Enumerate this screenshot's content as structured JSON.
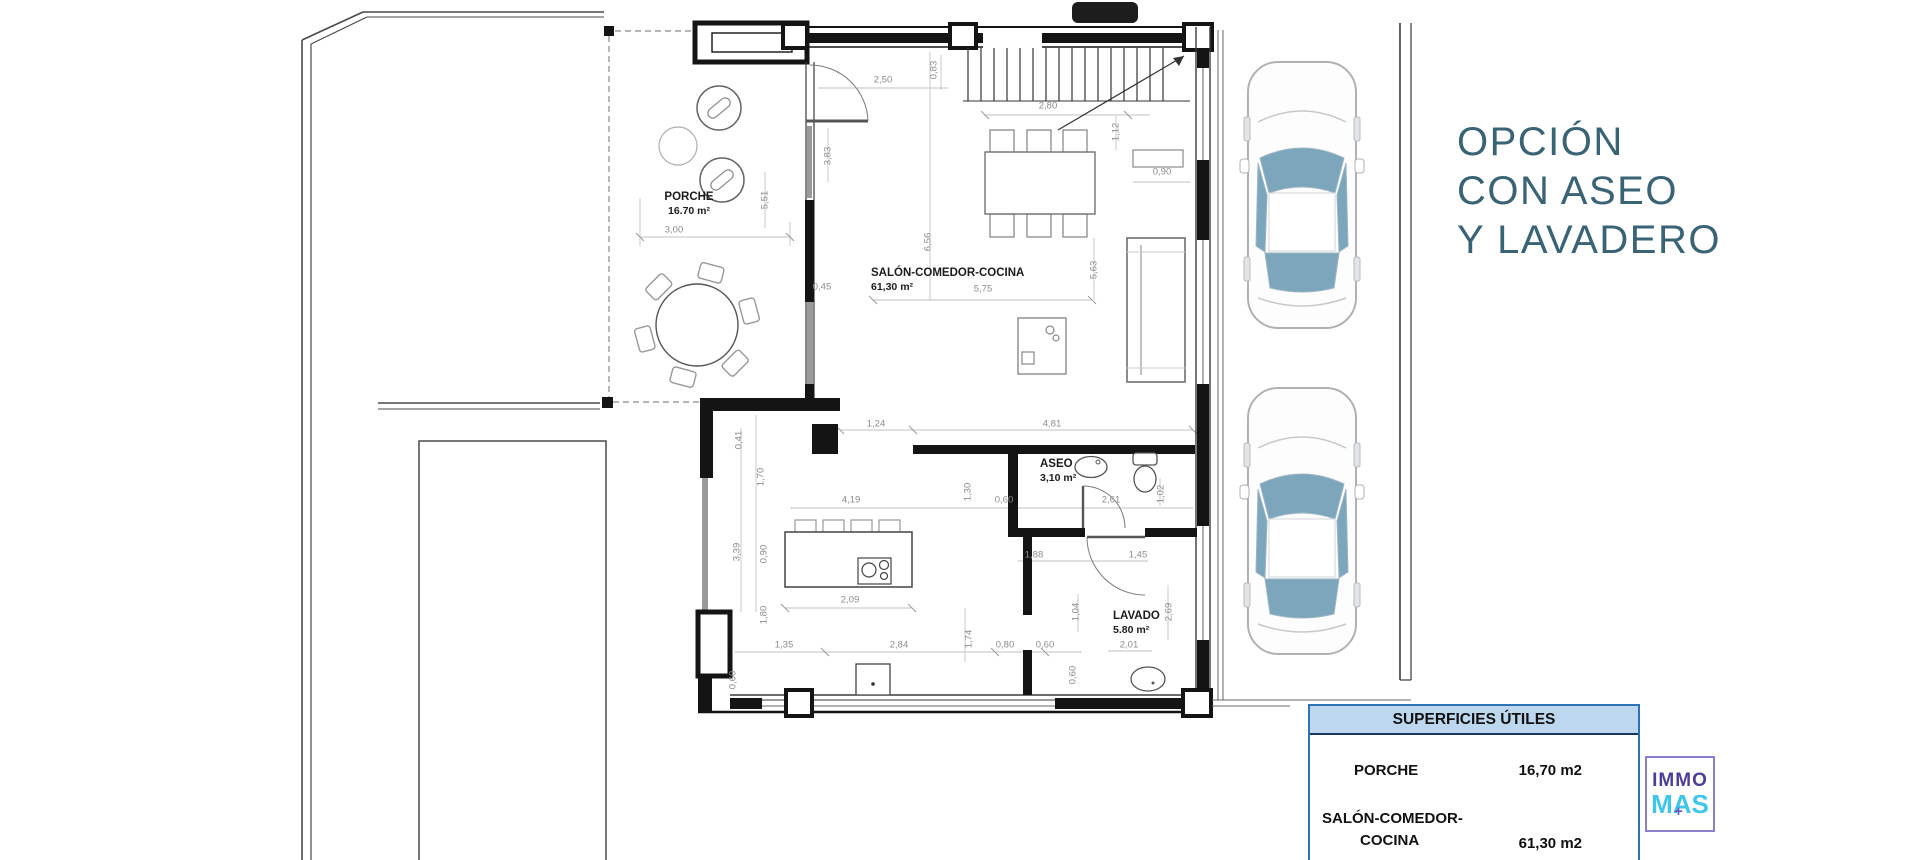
{
  "sidebar": {
    "title_lines": [
      "OPCIÓN",
      "CON ASEO",
      "Y LAVADERO"
    ]
  },
  "plan": {
    "room_labels": [
      {
        "name": "PORCHE",
        "area": "16.70 m²",
        "x": 689,
        "y": 190,
        "centered": true
      },
      {
        "name": "SALÓN-COMEDOR-COCINA",
        "area": "61,30 m²",
        "x": 871,
        "y": 266
      },
      {
        "name": "ASEO",
        "area": "3,10 m²",
        "x": 1040,
        "y": 457
      },
      {
        "name": "LAVADO",
        "area": "5.80 m²",
        "x": 1113,
        "y": 609
      }
    ],
    "dimension_labels": [
      {
        "t": "2,50",
        "x": 883,
        "y": 80
      },
      {
        "t": "0,83",
        "x": 934,
        "y": 70,
        "v": true
      },
      {
        "t": "2,80",
        "x": 1048,
        "y": 106
      },
      {
        "t": "1,12",
        "x": 1116,
        "y": 132,
        "v": true
      },
      {
        "t": "0,90",
        "x": 1162,
        "y": 172
      },
      {
        "t": "3,83",
        "x": 828,
        "y": 156,
        "v": true
      },
      {
        "t": "5,51",
        "x": 765,
        "y": 200,
        "v": true
      },
      {
        "t": "3,00",
        "x": 674,
        "y": 230
      },
      {
        "t": "6,56",
        "x": 928,
        "y": 242,
        "v": true
      },
      {
        "t": "5,75",
        "x": 983,
        "y": 289
      },
      {
        "t": "5,63",
        "x": 1094,
        "y": 270,
        "v": true
      },
      {
        "t": "0,45",
        "x": 822,
        "y": 287
      },
      {
        "t": "1,24",
        "x": 876,
        "y": 424
      },
      {
        "t": "4,81",
        "x": 1052,
        "y": 424
      },
      {
        "t": "0,41",
        "x": 739,
        "y": 440,
        "v": true
      },
      {
        "t": "1,70",
        "x": 761,
        "y": 477,
        "v": true
      },
      {
        "t": "4,19",
        "x": 851,
        "y": 500
      },
      {
        "t": "1,30",
        "x": 968,
        "y": 492,
        "v": true
      },
      {
        "t": "0,60",
        "x": 1004,
        "y": 500
      },
      {
        "t": "2,61",
        "x": 1111,
        "y": 500
      },
      {
        "t": "1,02",
        "x": 1161,
        "y": 494,
        "v": true
      },
      {
        "t": "3,39",
        "x": 737,
        "y": 552,
        "v": true
      },
      {
        "t": "0,90",
        "x": 764,
        "y": 554,
        "v": true
      },
      {
        "t": "1,88",
        "x": 1034,
        "y": 555
      },
      {
        "t": "1,45",
        "x": 1138,
        "y": 555
      },
      {
        "t": "2,09",
        "x": 850,
        "y": 600
      },
      {
        "t": "1,80",
        "x": 764,
        "y": 615,
        "v": true
      },
      {
        "t": "1,04",
        "x": 1076,
        "y": 612,
        "v": true
      },
      {
        "t": "2,69",
        "x": 1169,
        "y": 612,
        "v": true
      },
      {
        "t": "1,74",
        "x": 969,
        "y": 639,
        "v": true
      },
      {
        "t": "1,35",
        "x": 784,
        "y": 645
      },
      {
        "t": "2,84",
        "x": 899,
        "y": 645
      },
      {
        "t": "0,80",
        "x": 1005,
        "y": 645
      },
      {
        "t": "0,60",
        "x": 1045,
        "y": 645
      },
      {
        "t": "2,01",
        "x": 1129,
        "y": 645
      },
      {
        "t": "0,60",
        "x": 1073,
        "y": 675,
        "v": true
      },
      {
        "t": "0,60",
        "x": 733,
        "y": 680,
        "v": true
      }
    ]
  },
  "surfaces_table": {
    "header": "SUPERFICIES ÚTILES",
    "rows": [
      {
        "label": "PORCHE",
        "value": "16,70 m2"
      },
      {
        "label": "SALÓN-COMEDOR-",
        "label2": "COCINA",
        "value": "61,30 m2"
      }
    ]
  },
  "logo": {
    "top": "IMMO",
    "bottom": "MAS",
    "plus": "+"
  },
  "colors": {
    "title_color": "#3A6375",
    "table_border": "#2E74B5",
    "table_header_bg": "#BDD7EE",
    "table_header_rule": "#17365D",
    "logo_border": "#8F7FCA",
    "logo_purple": "#4B3F98",
    "logo_cyan": "#3FC6E8",
    "logo_plus": "#6B55C8",
    "car_glass": "#7CA6BC",
    "dim_text": "#8C8C8C"
  }
}
